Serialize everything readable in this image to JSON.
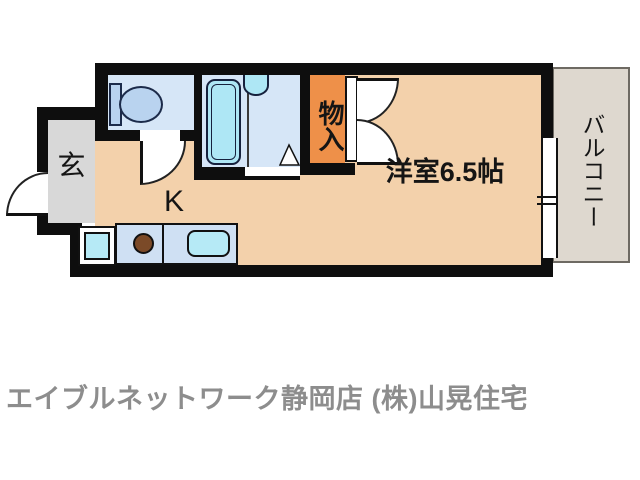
{
  "floor_plan": {
    "labels": {
      "entrance": "玄",
      "kitchen": "K",
      "closet": "物入",
      "main_room": "洋室6.5帖",
      "balcony": "バルコニー"
    },
    "footer": {
      "agency": "エイブルネットワーク静岡店 (株)山晃住宅"
    },
    "colors": {
      "wall": "#0e0e0e",
      "floor": "#f3d1ab",
      "entrance_floor": "#d8d8d8",
      "wet_room": "#d6e6f7",
      "closet": "#ee9049",
      "fixture_blue": "#b9d3ef",
      "fixture_cyan": "#aee7f5",
      "kitchen_counter": "#cfe0f3",
      "stove_burner": "#7b4a28",
      "balcony_floor": "#ded8cf",
      "footer_text": "#8d8d8d"
    }
  }
}
